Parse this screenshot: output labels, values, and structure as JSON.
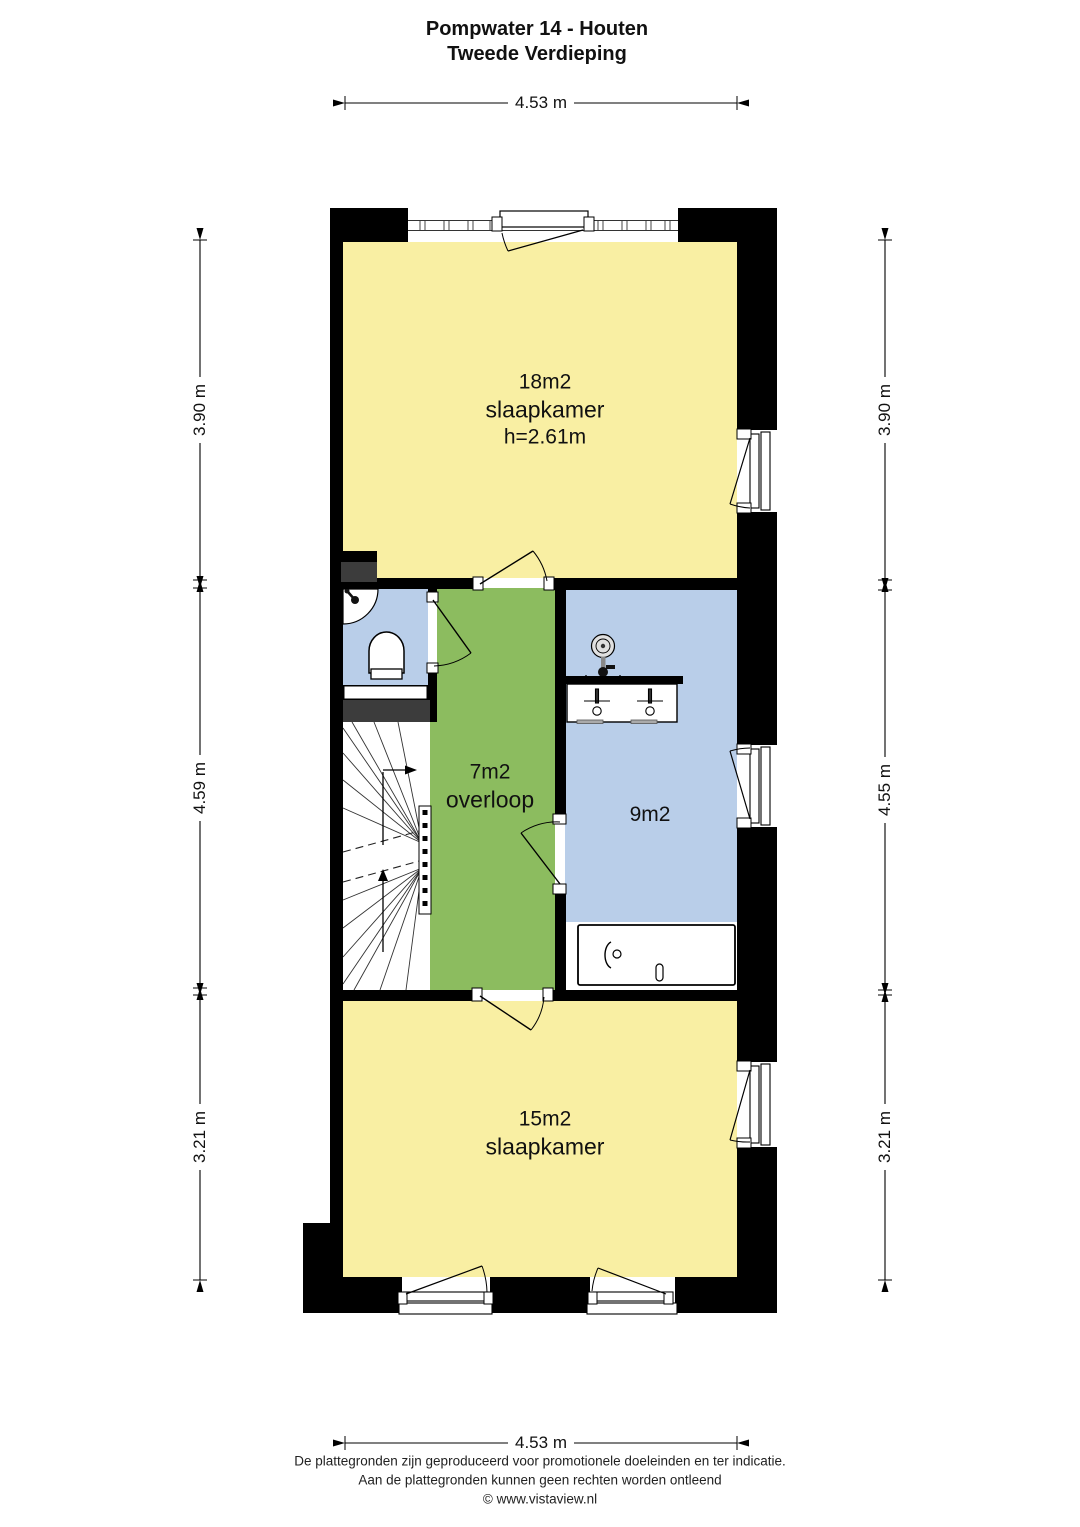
{
  "title": {
    "line1": "Pompwater 14 - Houten",
    "line2": "Tweede Verdieping"
  },
  "rooms": {
    "bedroom_large": {
      "area": "18m2",
      "type": "slaapkamer",
      "ceiling_height": "h=2.61m",
      "color": "#F9EFA3"
    },
    "landing": {
      "area": "7m2",
      "type": "overloop",
      "color": "#8CBC5F"
    },
    "bathroom": {
      "area": "9m2",
      "color": "#B9CEE9"
    },
    "bedroom_small": {
      "area": "15m2",
      "type": "slaapkamer",
      "color": "#F9EFA3"
    }
  },
  "fixtures": [
    "staircase",
    "corner-sink",
    "toilet",
    "shower",
    "double-washbasin",
    "bathtub"
  ],
  "dimensions": {
    "top": "4.53 m",
    "bottom": "4.53 m",
    "left_top": "3.90 m",
    "left_middle": "4.59 m",
    "left_bottom": "3.21 m",
    "right_top": "3.90 m",
    "right_middle": "4.55 m",
    "right_bottom": "3.21 m"
  },
  "footer": {
    "line1": "De plattegronden zijn geproduceerd voor promotionele doeleinden en ter indicatie.",
    "line2": "Aan de plattegronden kunnen geen rechten worden ontleend",
    "line3": "© www.vistaview.nl"
  },
  "colors": {
    "wall": "#000000",
    "shaft": "#3C3C3C",
    "room_yellow": "#F9EFA3",
    "room_green": "#8CBC5F",
    "room_blue": "#B9CEE9",
    "line": "#000000"
  }
}
